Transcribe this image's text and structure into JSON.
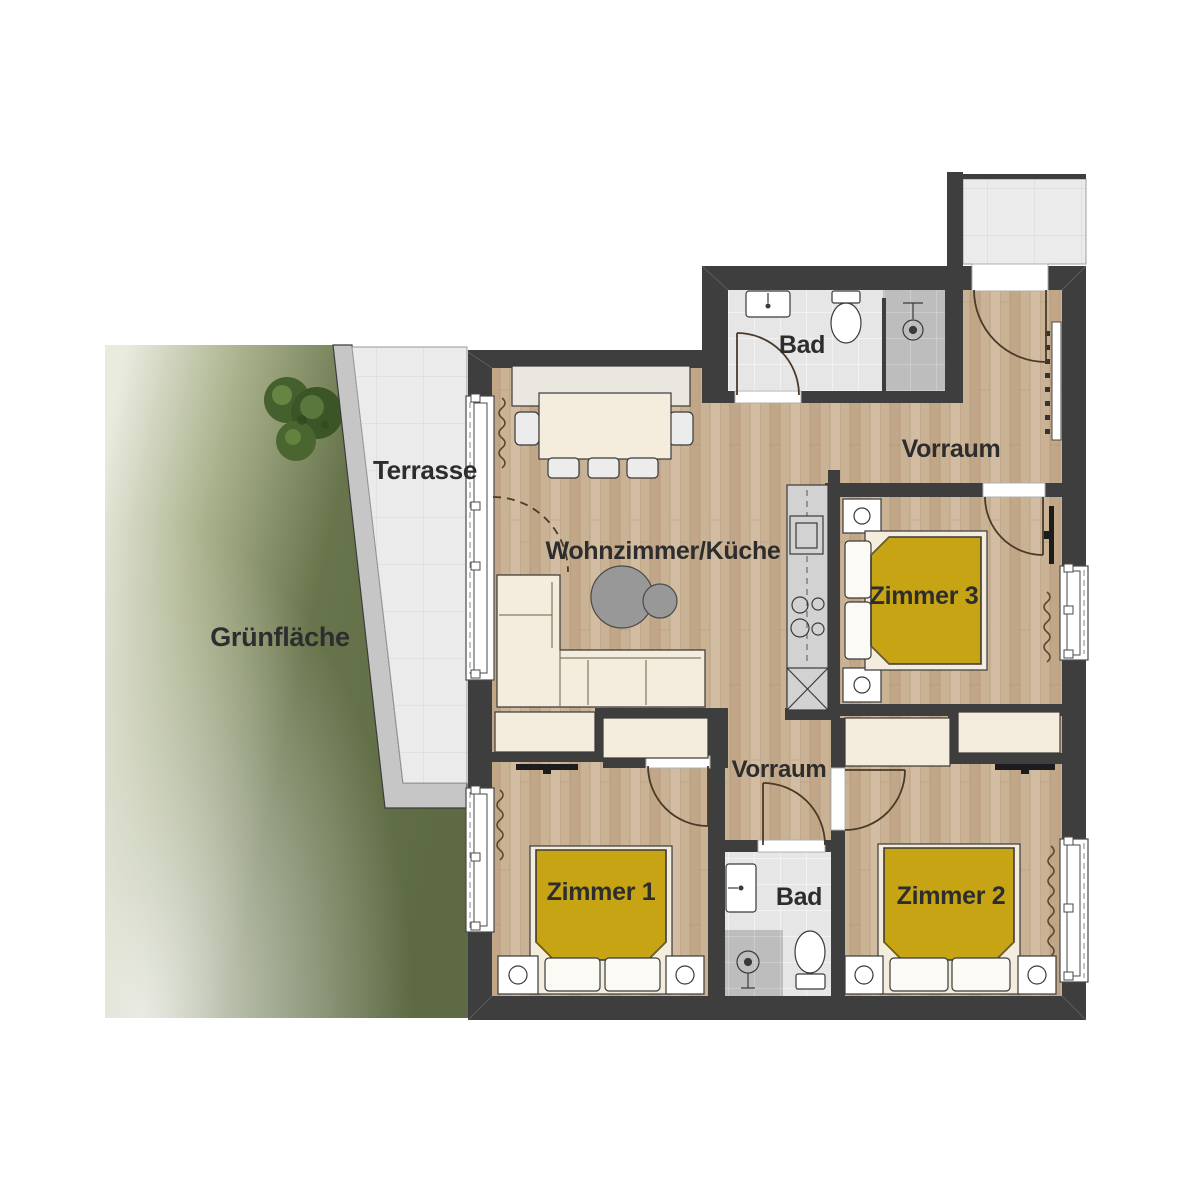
{
  "floorplan": {
    "labels": {
      "green_area": "Grünfläche",
      "terrace": "Terrasse",
      "living_kitchen": "Wohnzimmer/Küche",
      "bath_top": "Bad",
      "hall_top": "Vorraum",
      "room3": "Zimmer 3",
      "hall_bottom": "Vorraum",
      "room1": "Zimmer 1",
      "bath_bottom": "Bad",
      "room2": "Zimmer 2"
    },
    "colors": {
      "wall": "#3e3e3e",
      "wood_floor": "#cab295",
      "bed_yellow": "#c7a413",
      "furniture_cream": "#f4eddd",
      "terrace_tile": "#ebebeb",
      "bath_tile": "#e6e6e6",
      "shower_gray": "#bdbdbd",
      "grass_green": "#5f6c44",
      "terrace_band": "#c6c6c6"
    }
  }
}
